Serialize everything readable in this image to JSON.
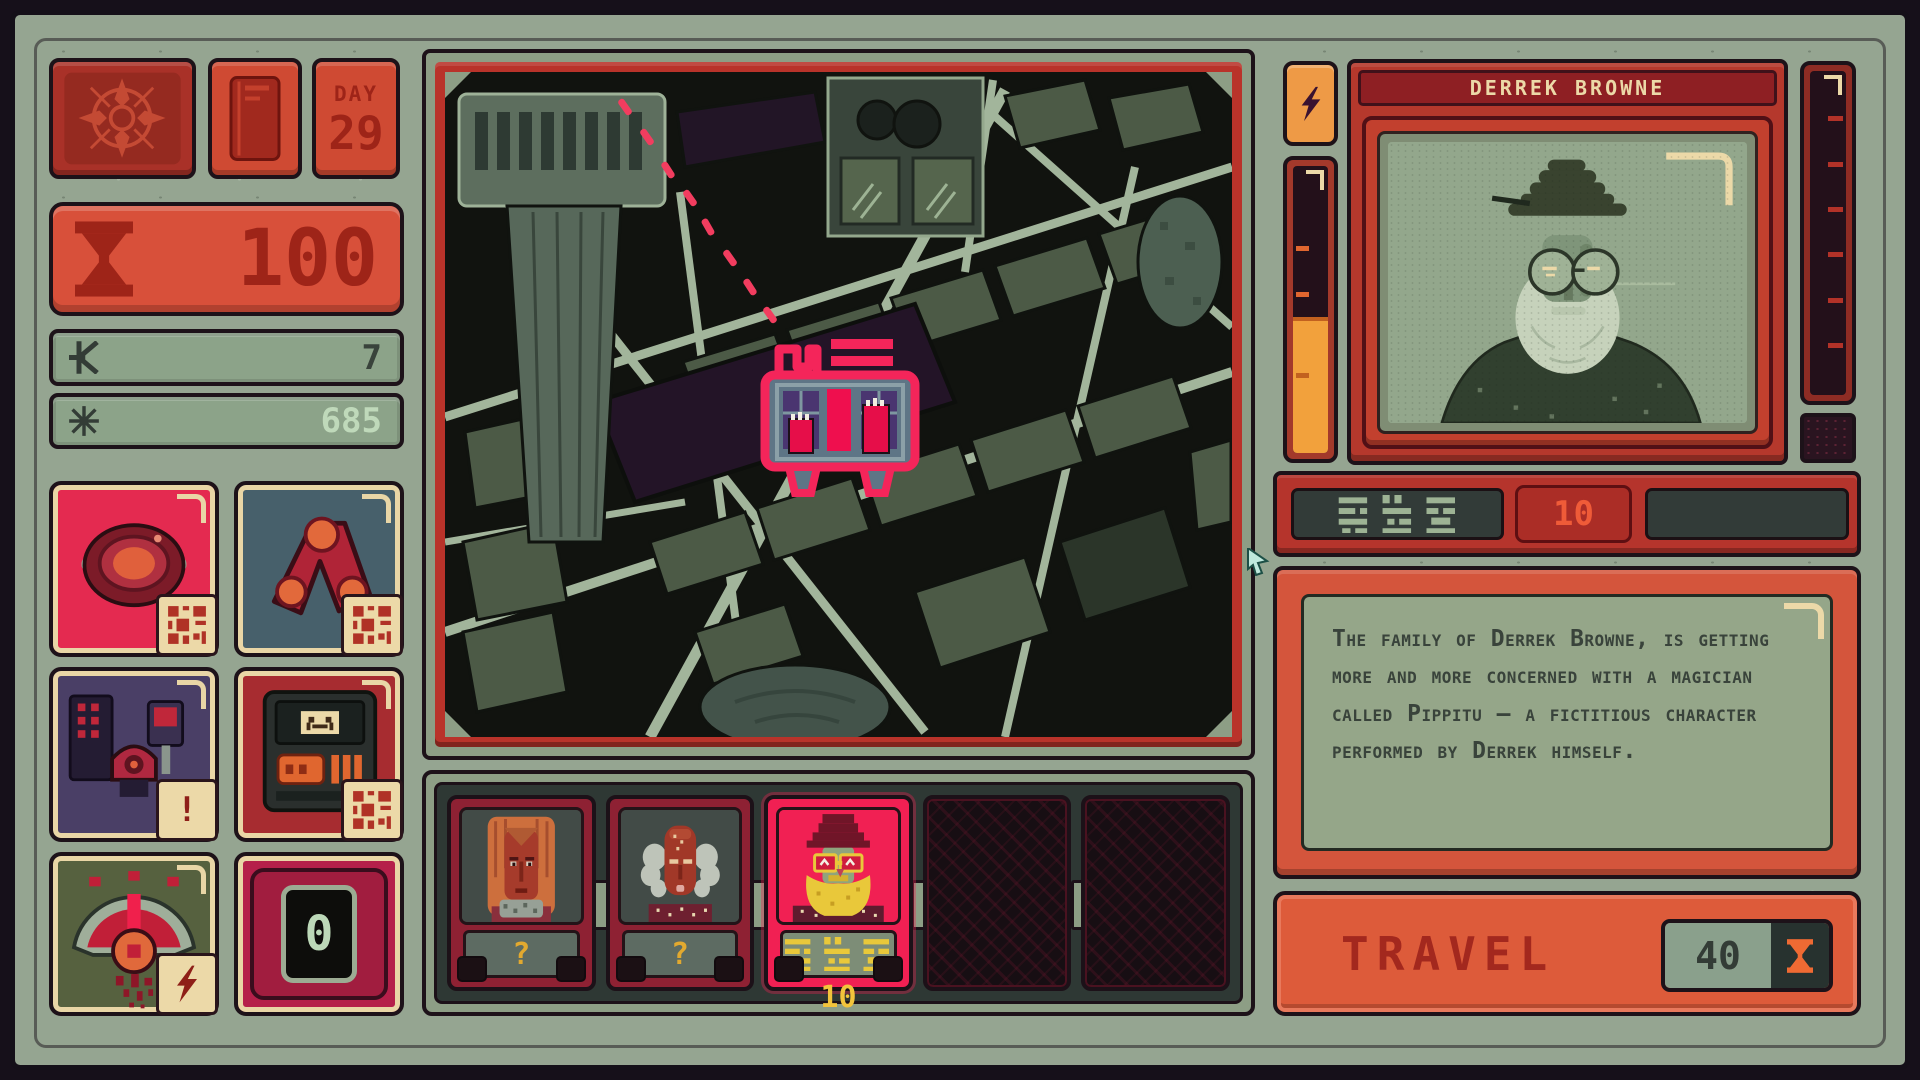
{
  "hud": {
    "day_label": "DAY",
    "day_value": "29",
    "time_value": "100",
    "money_value": "7",
    "energy_value": "685",
    "device_alert": "!",
    "device_counter": "0"
  },
  "crew": {
    "slots": [
      {
        "type": "unknown",
        "plaque": "?"
      },
      {
        "type": "unknown",
        "plaque": "?"
      },
      {
        "type": "selected",
        "price": "10"
      },
      {
        "type": "empty"
      },
      {
        "type": "empty"
      }
    ]
  },
  "patient": {
    "name": "DERREK BROWNE",
    "fee": "10",
    "description": "The family of Derrek Browne, is getting more and more concerned with a magician called Pippitu – a fictitious character performed by Derrek himself."
  },
  "travel": {
    "label": "TRAVEL",
    "cost": "40"
  },
  "colors": {
    "bezel_sage": "#95a591",
    "panel_red": "#b5382c",
    "accent_pink": "#f12053",
    "orange": "#f2a13c",
    "cream": "#ecd9a8",
    "yellow": "#e9c83a",
    "mint": "#bcd8b8",
    "map_street": "#a2b59b"
  }
}
